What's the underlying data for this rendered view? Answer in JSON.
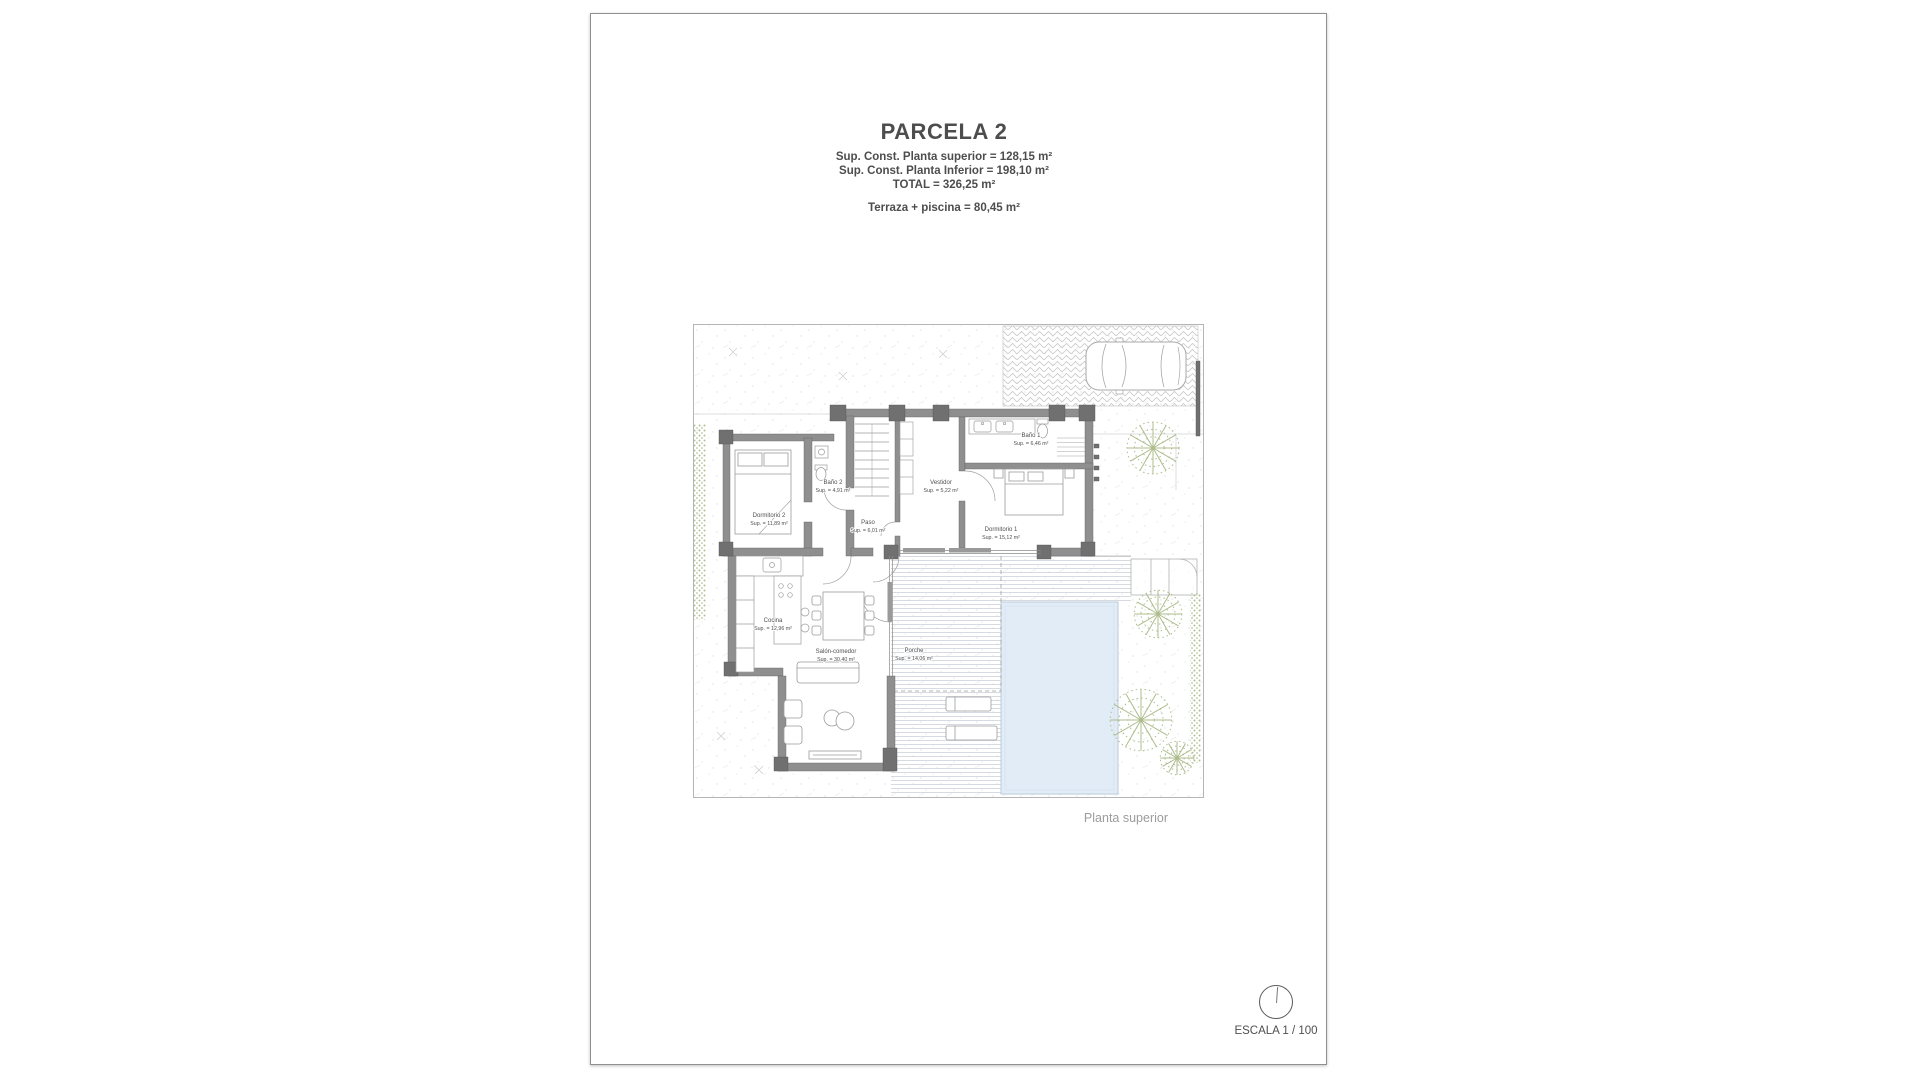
{
  "document": {
    "header": {
      "title": "PARCELA 2",
      "lines": [
        "Sup. Const. Planta superior = 128,15 m²",
        "Sup. Const. Planta Inferior = 198,10 m²",
        "TOTAL = 326,25 m²"
      ],
      "terrace": "Terraza + piscina = 80,45 m²"
    },
    "plan_caption": "Planta superior",
    "scale": {
      "label": "ESCALA 1 / 100"
    }
  },
  "floor_plan": {
    "rooms": [
      {
        "name": "Dormitorio 2",
        "area": "Sup. = 11,89 m²"
      },
      {
        "name": "Baño 2",
        "area": "Sup. = 4,91 m²"
      },
      {
        "name": "Paso",
        "area": "Sup. = 6,01 m²"
      },
      {
        "name": "Vestidor",
        "area": "Sup. = 5,22 m²"
      },
      {
        "name": "Baño 1",
        "area": "Sup. = 6,46 m²"
      },
      {
        "name": "Dormitorio 1",
        "area": "Sup. = 15,12 m²"
      },
      {
        "name": "Cocina",
        "area": "Sup. = 12,96 m²"
      },
      {
        "name": "Salón-comedor",
        "area": "Sup. = 30,40 m²"
      },
      {
        "name": "Porche",
        "area": "Sup. = 14,06 m²"
      }
    ],
    "colors": {
      "wall": "#8f8f8f",
      "wall_pier": "#707070",
      "pool": "#e2ecf6",
      "deck_line": "#c3ccd3",
      "tree": "#adbc8c",
      "hedge": "#b2bf90",
      "hatch_dot": "#dedede",
      "paving": "#c9c9c9",
      "label_text": "#4f4f4f",
      "caption_text": "#9c9c9c"
    }
  }
}
